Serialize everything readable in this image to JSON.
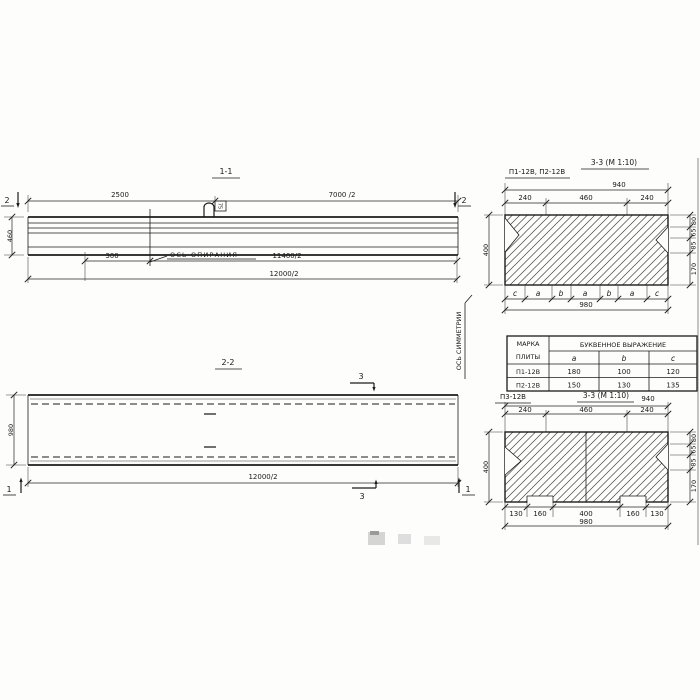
{
  "s11": {
    "title": "1-1",
    "dim_2500": "2500",
    "dim_7000": "7000 /2",
    "marker": "2",
    "height_dim": "460",
    "dim_300": "300",
    "support_axis_label": "ОСЬ ОПИРАНИЯ",
    "dim_11400": "11400/2",
    "dim_12000": "12000/2",
    "hook_tag": "75"
  },
  "s22": {
    "title": "2-2",
    "marker_3": "3",
    "marker_1": "1",
    "width_dim": "980",
    "length_dim": "12000/2",
    "symmetry_axis_label": "ОСЬ СИММЕТРИИ"
  },
  "s33a": {
    "subtitle": "П1-12В, П2-12В",
    "title": "3-3 (М 1:10)",
    "total_top": "940",
    "top_dims": [
      "240",
      "460",
      "240"
    ],
    "height": "400",
    "right_dims": [
      "80",
      "65",
      "85",
      "170"
    ],
    "letters": [
      "c",
      "a",
      "b",
      "a",
      "b",
      "a",
      "c"
    ],
    "total_bottom": "980"
  },
  "table": {
    "col1_line1": "МАРКА",
    "col1_line2": "ПЛИТЫ",
    "group_header": "БУКВЕННОЕ  ВЫРАЖЕНИЕ",
    "cols": [
      "a",
      "b",
      "c"
    ],
    "rows": [
      [
        "П1-12В",
        "180",
        "100",
        "120"
      ],
      [
        "П2-12В",
        "150",
        "130",
        "135"
      ]
    ]
  },
  "s33b": {
    "label": "П3-12В",
    "title": "3-3 (М 1:10)",
    "total_top": "940",
    "top_dims": [
      "240",
      "460",
      "240"
    ],
    "height": "400",
    "right_dims": [
      "80",
      "65",
      "85",
      "170"
    ],
    "bottom_dims": [
      "130",
      "160",
      "400",
      "160",
      "130"
    ],
    "total_bottom": "980"
  }
}
